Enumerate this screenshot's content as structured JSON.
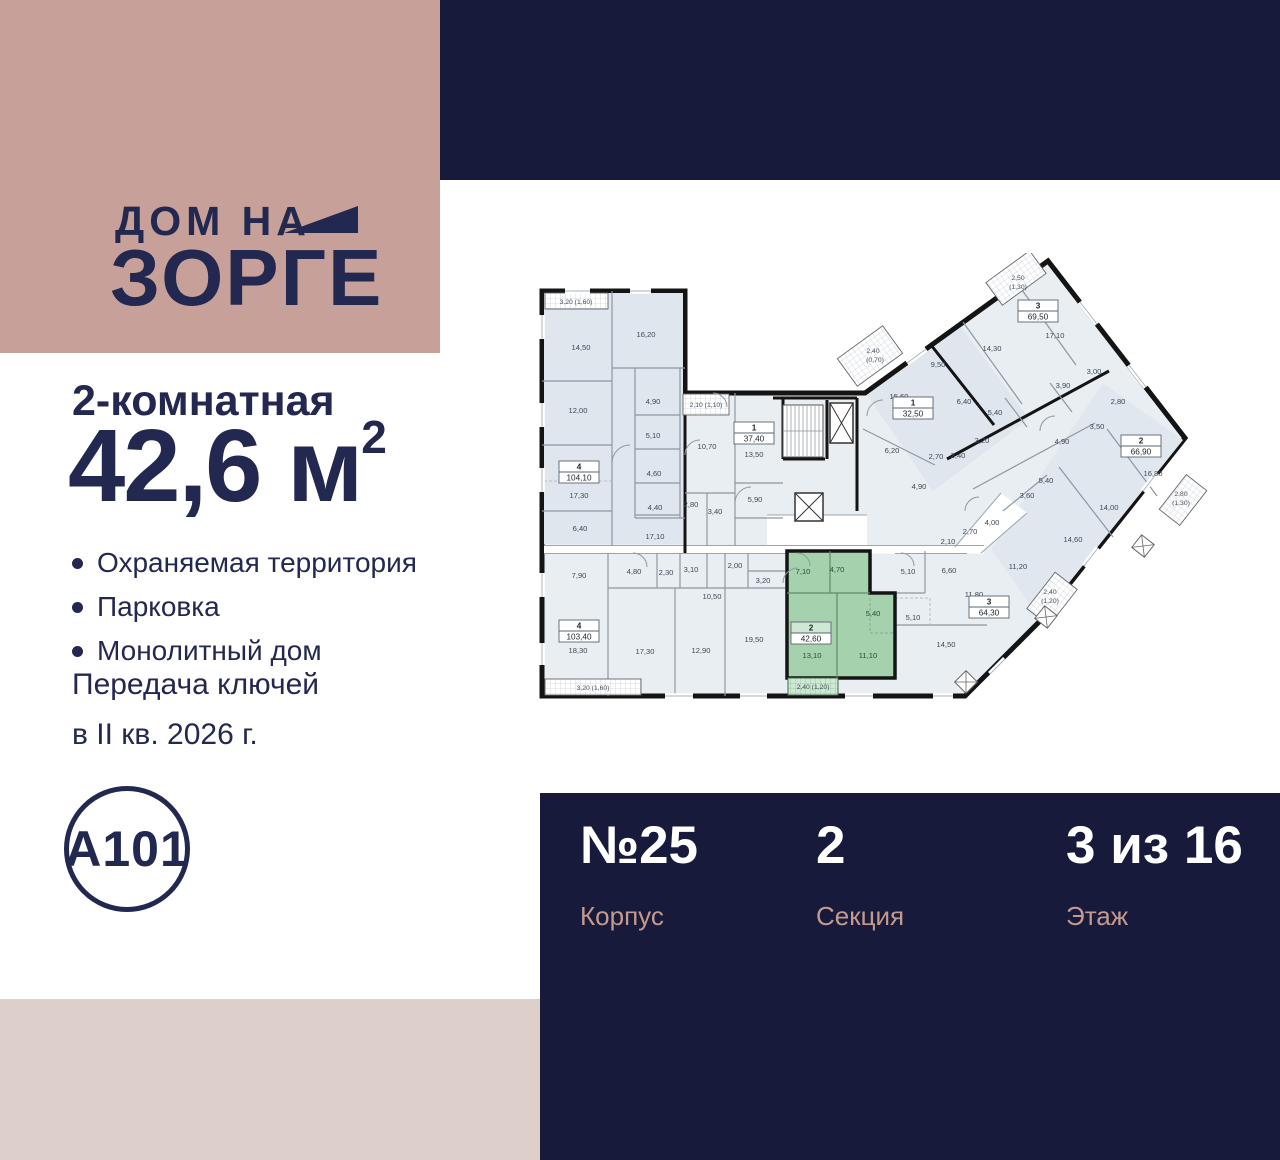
{
  "brand": {
    "logo_top": "ДОМ НА",
    "logo_bottom": "ЗОРГЕ",
    "developer": "А101"
  },
  "listing": {
    "rooms_title": "2-комнатная",
    "area": "42,6",
    "area_unit": "м",
    "area_exp": "2",
    "features": [
      "Охраняемая территория",
      "Парковка",
      "Монолитный дом"
    ],
    "handover": [
      "Передача ключей",
      "в II кв. 2026 г."
    ]
  },
  "info_panel": {
    "items": [
      {
        "value": "№25",
        "label": "Корпус"
      },
      {
        "value": "2",
        "label": "Секция"
      },
      {
        "value": "3 из 16",
        "label": "Этаж"
      }
    ]
  },
  "colors": {
    "navy": "#171a3a",
    "rose": "#c7a199",
    "beige": "#ddcfc9",
    "text_navy": "#232850",
    "panel_label_rose": "#c49a8f",
    "plan_room": "#e9eef3",
    "plan_wall": "#141414",
    "plan_highlight_green": "#a5d2ac"
  },
  "floor_plan": {
    "highlighted_apartment": {
      "number": "2",
      "total_area": "42,60",
      "rooms": [
        "7,10",
        "4,70",
        "5,40",
        "13,10",
        "11,10"
      ],
      "balcony": "2,40 (1,20)"
    },
    "apartment_boxes": [
      {
        "num": "4",
        "area": "104,10",
        "x": 44,
        "y": 226
      },
      {
        "num": "1",
        "area": "37,40",
        "x": 219,
        "y": 187
      },
      {
        "num": "4",
        "area": "103,40",
        "x": 44,
        "y": 385
      },
      {
        "num": "2",
        "area": "42,60",
        "x": 276,
        "y": 387,
        "hl": true
      },
      {
        "num": "3",
        "area": "64,30",
        "x": 454,
        "y": 361
      },
      {
        "num": "1",
        "area": "32,50",
        "x": 378,
        "y": 162
      },
      {
        "num": "3",
        "area": "69,50",
        "x": 503,
        "y": 65
      },
      {
        "num": "2",
        "area": "66,90",
        "x": 606,
        "y": 200
      }
    ],
    "room_labels": [
      {
        "t": "14,50",
        "x": 46,
        "y": 97
      },
      {
        "t": "16,20",
        "x": 111,
        "y": 84
      },
      {
        "t": "12,00",
        "x": 43,
        "y": 160
      },
      {
        "t": "4,90",
        "x": 118,
        "y": 151
      },
      {
        "t": "5,10",
        "x": 118,
        "y": 185
      },
      {
        "t": "4,60",
        "x": 119,
        "y": 223
      },
      {
        "t": "4,40",
        "x": 120,
        "y": 257
      },
      {
        "t": "2,80",
        "x": 156,
        "y": 254
      },
      {
        "t": "3,40",
        "x": 180,
        "y": 261
      },
      {
        "t": "17,10",
        "x": 120,
        "y": 286
      },
      {
        "t": "6,40",
        "x": 45,
        "y": 278
      },
      {
        "t": "17,30",
        "x": 44,
        "y": 245
      },
      {
        "t": "10,70",
        "x": 172,
        "y": 196
      },
      {
        "t": "13,50",
        "x": 219,
        "y": 204
      },
      {
        "t": "5,90",
        "x": 220,
        "y": 249
      },
      {
        "t": "7,90",
        "x": 44,
        "y": 325
      },
      {
        "t": "4,80",
        "x": 99,
        "y": 321
      },
      {
        "t": "2,30",
        "x": 131,
        "y": 322
      },
      {
        "t": "3,10",
        "x": 156,
        "y": 319
      },
      {
        "t": "2,00",
        "x": 200,
        "y": 315
      },
      {
        "t": "3,20",
        "x": 228,
        "y": 330
      },
      {
        "t": "10,50",
        "x": 177,
        "y": 346
      },
      {
        "t": "18,30",
        "x": 43,
        "y": 400
      },
      {
        "t": "17,30",
        "x": 110,
        "y": 401
      },
      {
        "t": "12,90",
        "x": 166,
        "y": 400
      },
      {
        "t": "19,50",
        "x": 219,
        "y": 389
      },
      {
        "t": "7,10",
        "x": 268,
        "y": 321,
        "g": 1
      },
      {
        "t": "4,70",
        "x": 302,
        "y": 319,
        "g": 1
      },
      {
        "t": "5,40",
        "x": 338,
        "y": 363,
        "g": 1
      },
      {
        "t": "13,10",
        "x": 277,
        "y": 405,
        "g": 1
      },
      {
        "t": "11,10",
        "x": 333,
        "y": 405,
        "g": 1
      },
      {
        "t": "5,10",
        "x": 373,
        "y": 321
      },
      {
        "t": "6,60",
        "x": 414,
        "y": 320
      },
      {
        "t": "11,80",
        "x": 439,
        "y": 344
      },
      {
        "t": "5,10",
        "x": 378,
        "y": 367
      },
      {
        "t": "14,50",
        "x": 411,
        "y": 394
      },
      {
        "t": "2,70",
        "x": 435,
        "y": 281
      },
      {
        "t": "2,10",
        "x": 413,
        "y": 291
      },
      {
        "t": "4,00",
        "x": 457,
        "y": 272
      },
      {
        "t": "11,20",
        "x": 483,
        "y": 316
      },
      {
        "t": "3,60",
        "x": 492,
        "y": 245
      },
      {
        "t": "5,40",
        "x": 511,
        "y": 230
      },
      {
        "t": "15,60",
        "x": 364,
        "y": 146
      },
      {
        "t": "6,20",
        "x": 357,
        "y": 200
      },
      {
        "t": "4,90",
        "x": 384,
        "y": 236
      },
      {
        "t": "2,70",
        "x": 401,
        "y": 206
      },
      {
        "t": "2,40",
        "x": 423,
        "y": 205
      },
      {
        "t": "3,20",
        "x": 447,
        "y": 190
      },
      {
        "t": "17,10",
        "x": 520,
        "y": 85
      },
      {
        "t": "14,30",
        "x": 457,
        "y": 98
      },
      {
        "t": "9,50",
        "x": 403,
        "y": 114
      },
      {
        "t": "6,40",
        "x": 429,
        "y": 151
      },
      {
        "t": "5,40",
        "x": 460,
        "y": 162
      },
      {
        "t": "3,90",
        "x": 528,
        "y": 135
      },
      {
        "t": "3,00",
        "x": 559,
        "y": 121
      },
      {
        "t": "16,80",
        "x": 618,
        "y": 223
      },
      {
        "t": "2,80",
        "x": 583,
        "y": 151
      },
      {
        "t": "3,50",
        "x": 562,
        "y": 176
      },
      {
        "t": "4,90",
        "x": 527,
        "y": 191
      },
      {
        "t": "14,00",
        "x": 574,
        "y": 257
      },
      {
        "t": "14,60",
        "x": 538,
        "y": 289
      }
    ],
    "balcony_labels": [
      {
        "t": "3,20 (1,60)",
        "x": 41,
        "y": 51
      },
      {
        "t": "2,10 (1,10)",
        "x": 171,
        "y": 154
      },
      {
        "t": "3,20 (1,60)",
        "x": 58,
        "y": 437
      },
      {
        "t": "2,40 (1,20)",
        "x": 278,
        "y": 436
      },
      {
        "t": "2,40",
        "x": 338,
        "y": 100
      },
      {
        "t": "(0,70)",
        "x": 340,
        "y": 109
      },
      {
        "t": "2,50",
        "x": 483,
        "y": 27
      },
      {
        "t": "(1,30)",
        "x": 483,
        "y": 36
      },
      {
        "t": "2,80",
        "x": 646,
        "y": 243
      },
      {
        "t": "(1,30)",
        "x": 646,
        "y": 252
      },
      {
        "t": "2,40",
        "x": 515,
        "y": 341
      },
      {
        "t": "(1,20)",
        "x": 515,
        "y": 350
      }
    ]
  }
}
